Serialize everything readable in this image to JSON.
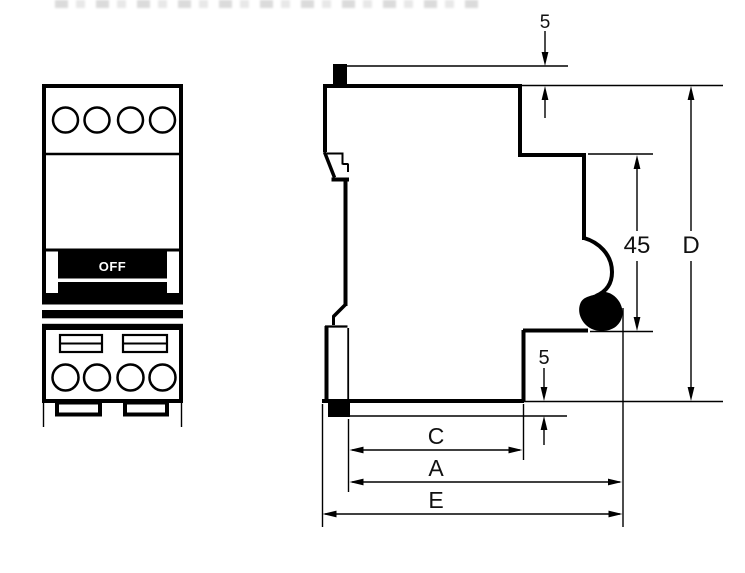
{
  "front_view": {
    "toggle_label": "OFF"
  },
  "dimensions": {
    "top_clip_protrusion": "5",
    "bottom_clip_protrusion": "5",
    "recess_height": "45",
    "total_height": "D",
    "width_c": "C",
    "width_a": "A",
    "width_e": "E"
  },
  "colors": {
    "line": "#000000",
    "background": "#ffffff"
  }
}
